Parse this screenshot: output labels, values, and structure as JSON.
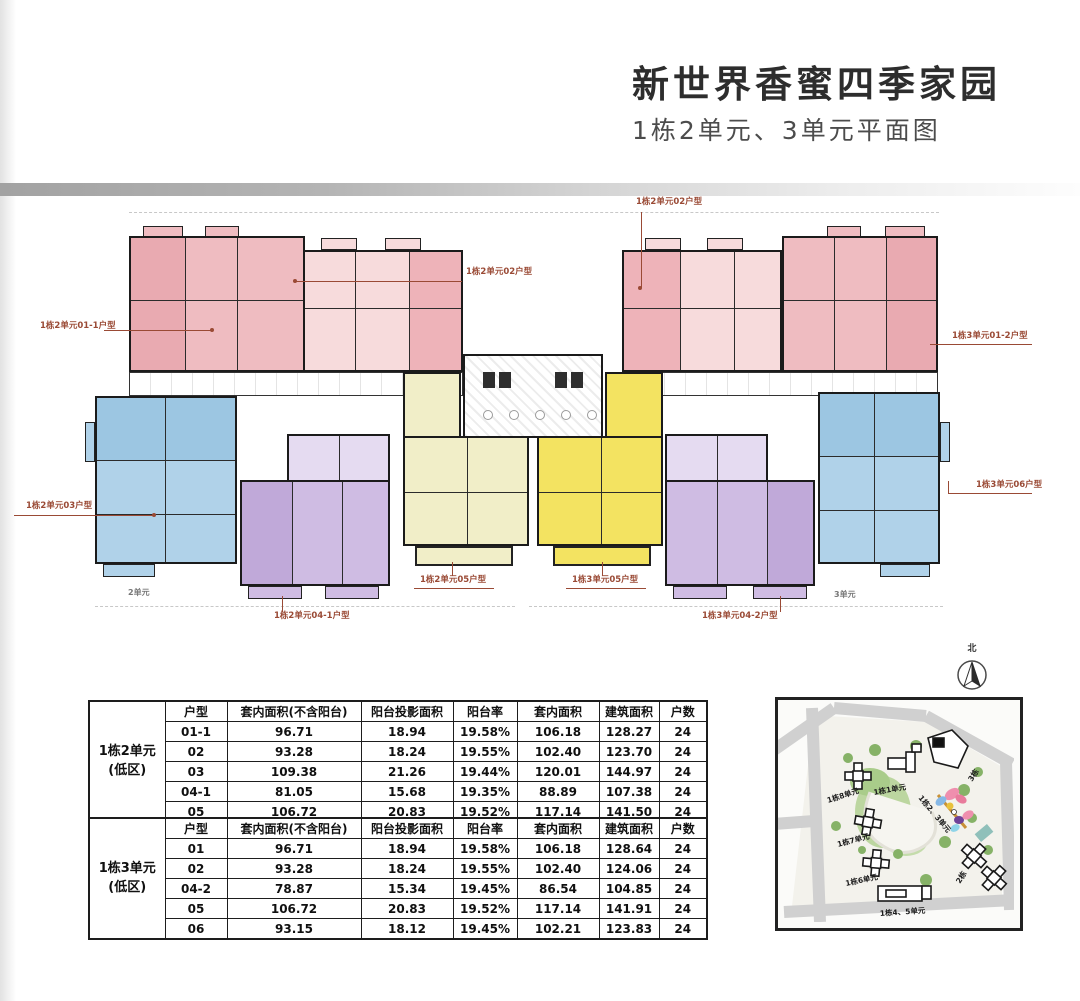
{
  "header": {
    "title": "新世界香蜜四季家园",
    "subtitle": "1栋2单元、3单元平面图"
  },
  "plan": {
    "unit_labels": [
      "1栋2单元02户型",
      "1栋2单元02户型",
      "1栋2单元01-1户型",
      "1栋3单元01-2户型",
      "1栋2单元03户型",
      "1栋3单元06户型",
      "1栋2单元05户型",
      "1栋3单元05户型",
      "1栋2单元04-1户型",
      "1栋3单元04-2户型"
    ],
    "wing_left": "2单元",
    "wing_right": "3单元",
    "compass_north": "北"
  },
  "tables": {
    "headers": [
      "户型",
      "套内面积(不含阳台)",
      "阳台投影面积",
      "阳台率",
      "套内面积",
      "建筑面积",
      "户数"
    ],
    "groups": [
      {
        "name": "1栋2单元",
        "zone": "(低区)",
        "rows": [
          [
            "01-1",
            "96.71",
            "18.94",
            "19.58%",
            "106.18",
            "128.27",
            "24"
          ],
          [
            "02",
            "93.28",
            "18.24",
            "19.55%",
            "102.40",
            "123.70",
            "24"
          ],
          [
            "03",
            "109.38",
            "21.26",
            "19.44%",
            "120.01",
            "144.97",
            "24"
          ],
          [
            "04-1",
            "81.05",
            "15.68",
            "19.35%",
            "88.89",
            "107.38",
            "24"
          ],
          [
            "05",
            "106.72",
            "20.83",
            "19.52%",
            "117.14",
            "141.50",
            "24"
          ]
        ]
      },
      {
        "name": "1栋3单元",
        "zone": "(低区)",
        "rows": [
          [
            "01",
            "96.71",
            "18.94",
            "19.58%",
            "106.18",
            "128.64",
            "24"
          ],
          [
            "02",
            "93.28",
            "18.24",
            "19.55%",
            "102.40",
            "124.06",
            "24"
          ],
          [
            "04-2",
            "78.87",
            "15.34",
            "19.45%",
            "86.54",
            "104.85",
            "24"
          ],
          [
            "05",
            "106.72",
            "20.83",
            "19.52%",
            "117.14",
            "141.91",
            "24"
          ],
          [
            "06",
            "93.15",
            "18.12",
            "19.45%",
            "102.21",
            "123.83",
            "24"
          ]
        ]
      }
    ]
  },
  "site_map": {
    "labels": [
      "1栋8单元",
      "1栋1单元",
      "1栋7单元",
      "1栋6单元",
      "1栋4、5单元",
      "2栋",
      "3栋",
      "1栋2、3单元"
    ]
  },
  "colors": {
    "label_red": "#9a4a35",
    "pink": "#efbcc1",
    "pink_light": "#f7dbdc",
    "blue": "#b0d2e9",
    "purple": "#cfbce3",
    "purple_light": "#e5dbf1",
    "yellow_pale": "#f1eec8",
    "yellow_bright": "#f3e361"
  }
}
